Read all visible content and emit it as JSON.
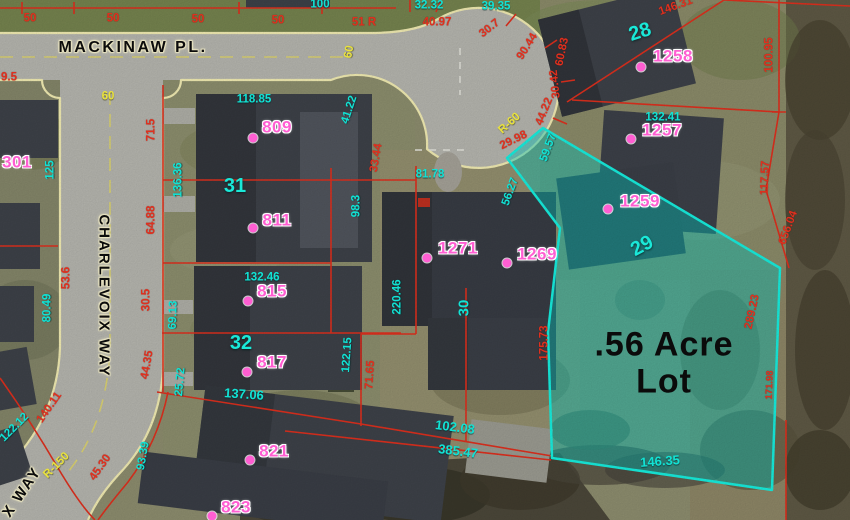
{
  "streets": {
    "mackinaw": "MACKINAW PL.",
    "charlevoix": "CHARLEVOIX WAY",
    "charlevoix_partial": "X WAY"
  },
  "highlight": {
    "area_line1": ".56 Acre",
    "area_line2": "Lot"
  },
  "addresses": [
    {
      "label": "301",
      "x": 17,
      "y": 162,
      "dot": null
    },
    {
      "label": "809",
      "x": 277,
      "y": 127,
      "dot": [
        253,
        138
      ]
    },
    {
      "label": "811",
      "x": 277,
      "y": 220,
      "dot": [
        253,
        228
      ]
    },
    {
      "label": "815",
      "x": 272,
      "y": 291,
      "dot": [
        248,
        301
      ]
    },
    {
      "label": "817",
      "x": 272,
      "y": 362,
      "dot": [
        247,
        372
      ]
    },
    {
      "label": "821",
      "x": 274,
      "y": 451,
      "dot": [
        250,
        460
      ]
    },
    {
      "label": "823",
      "x": 236,
      "y": 507,
      "dot": [
        212,
        516
      ]
    },
    {
      "label": "1258",
      "x": 673,
      "y": 56,
      "dot": [
        641,
        67
      ]
    },
    {
      "label": "1257",
      "x": 662,
      "y": 130,
      "dot": [
        631,
        139
      ]
    },
    {
      "label": "1259",
      "x": 640,
      "y": 201,
      "dot": [
        608,
        209
      ]
    },
    {
      "label": "1271",
      "x": 458,
      "y": 248,
      "dot": [
        427,
        258
      ]
    },
    {
      "label": "1269",
      "x": 537,
      "y": 254,
      "dot": [
        507,
        263
      ]
    }
  ],
  "lot_numbers": [
    {
      "label": "31",
      "x": 235,
      "y": 186,
      "r": 0
    },
    {
      "label": "32",
      "x": 241,
      "y": 343,
      "r": 0
    },
    {
      "label": "28",
      "x": 640,
      "y": 32,
      "r": -18
    },
    {
      "label": "29",
      "x": 642,
      "y": 246,
      "r": -28
    }
  ],
  "dimensions": [
    {
      "t": "50",
      "c": "red",
      "x": 30,
      "y": 19,
      "r": 0
    },
    {
      "t": "50",
      "c": "red",
      "x": 113,
      "y": 19,
      "r": 0
    },
    {
      "t": "50",
      "c": "red",
      "x": 198,
      "y": 20,
      "r": 0
    },
    {
      "t": "50",
      "c": "red",
      "x": 278,
      "y": 21,
      "r": 0
    },
    {
      "t": "100",
      "c": "cyan",
      "x": 320,
      "y": 5,
      "r": 0
    },
    {
      "t": "32.32",
      "c": "cyan",
      "x": 429,
      "y": 6,
      "r": 0
    },
    {
      "t": "39.35",
      "c": "cyan",
      "x": 496,
      "y": 7,
      "r": 0
    },
    {
      "t": "51 R",
      "c": "red",
      "x": 364,
      "y": 23,
      "r": 0
    },
    {
      "t": "40.97",
      "c": "red",
      "x": 437,
      "y": 23,
      "r": 0
    },
    {
      "t": "30.7",
      "c": "red",
      "x": 490,
      "y": 29,
      "r": -38
    },
    {
      "t": "90.44",
      "c": "red",
      "x": 528,
      "y": 47,
      "r": -58
    },
    {
      "t": "60.83",
      "c": "red",
      "x": 563,
      "y": 52,
      "r": -78
    },
    {
      "t": "30.42",
      "c": "red",
      "x": 556,
      "y": 84,
      "r": -96
    },
    {
      "t": "44.22",
      "c": "red",
      "x": 545,
      "y": 112,
      "r": -68
    },
    {
      "t": "R-60",
      "c": "yellow",
      "x": 510,
      "y": 124,
      "r": -42
    },
    {
      "t": "29.98",
      "c": "red",
      "x": 514,
      "y": 141,
      "r": -26
    },
    {
      "t": "59.57",
      "c": "cyan",
      "x": 549,
      "y": 148,
      "r": -70
    },
    {
      "t": "56.27",
      "c": "cyan",
      "x": 511,
      "y": 192,
      "r": -70
    },
    {
      "t": "60",
      "c": "yellow",
      "x": 350,
      "y": 52,
      "r": -80
    },
    {
      "t": "60",
      "c": "yellow",
      "x": 108,
      "y": 97,
      "r": 0
    },
    {
      "t": "9.5",
      "c": "red",
      "x": 9,
      "y": 78,
      "r": 0
    },
    {
      "t": "118.85",
      "c": "cyan",
      "x": 254,
      "y": 100,
      "r": 0
    },
    {
      "t": "41.22",
      "c": "cyan",
      "x": 350,
      "y": 110,
      "r": -72
    },
    {
      "t": "33.44",
      "c": "red",
      "x": 377,
      "y": 158,
      "r": -80
    },
    {
      "t": "98.3",
      "c": "cyan",
      "x": 357,
      "y": 206,
      "r": -90
    },
    {
      "t": "81.78",
      "c": "cyan",
      "x": 430,
      "y": 175,
      "r": 0
    },
    {
      "t": "220.46",
      "c": "cyan",
      "x": 398,
      "y": 297,
      "r": -90
    },
    {
      "t": "30",
      "c": "cyan",
      "x": 464,
      "y": 308,
      "r": -90,
      "s": 15
    },
    {
      "t": "132.41",
      "c": "cyan",
      "x": 663,
      "y": 118,
      "r": 0
    },
    {
      "t": "146.31",
      "c": "red",
      "x": 676,
      "y": 7,
      "r": -20
    },
    {
      "t": "100.95",
      "c": "red",
      "x": 770,
      "y": 55,
      "r": -90
    },
    {
      "t": "117.57",
      "c": "red",
      "x": 766,
      "y": 178,
      "r": -88
    },
    {
      "t": "656.04",
      "c": "red",
      "x": 789,
      "y": 228,
      "r": -70
    },
    {
      "t": "289.23",
      "c": "red",
      "x": 753,
      "y": 312,
      "r": -78
    },
    {
      "t": "171.98",
      "c": "red",
      "x": 770,
      "y": 385,
      "r": -88,
      "s": 9.5
    },
    {
      "t": "175.73",
      "c": "red",
      "x": 545,
      "y": 343,
      "r": -90
    },
    {
      "t": "146.35",
      "c": "cyan",
      "x": 660,
      "y": 461,
      "r": -4,
      "s": 13
    },
    {
      "t": "102.08",
      "c": "cyan",
      "x": 455,
      "y": 427,
      "r": 7,
      "s": 13
    },
    {
      "t": "385.47",
      "c": "cyan",
      "x": 458,
      "y": 451,
      "r": 7,
      "s": 13
    },
    {
      "t": "125",
      "c": "cyan",
      "x": 51,
      "y": 170,
      "r": -90
    },
    {
      "t": "71.5",
      "c": "red",
      "x": 152,
      "y": 130,
      "r": -90
    },
    {
      "t": "136.36",
      "c": "cyan",
      "x": 179,
      "y": 180,
      "r": -90
    },
    {
      "t": "64.88",
      "c": "red",
      "x": 152,
      "y": 220,
      "r": -90
    },
    {
      "t": "53.6",
      "c": "red",
      "x": 67,
      "y": 278,
      "r": -90
    },
    {
      "t": "80.49",
      "c": "cyan",
      "x": 48,
      "y": 308,
      "r": -90
    },
    {
      "t": "30.5",
      "c": "red",
      "x": 147,
      "y": 300,
      "r": -90
    },
    {
      "t": "69.13",
      "c": "cyan",
      "x": 174,
      "y": 315,
      "r": -88
    },
    {
      "t": "44.35",
      "c": "red",
      "x": 148,
      "y": 365,
      "r": -80
    },
    {
      "t": "25.72",
      "c": "cyan",
      "x": 181,
      "y": 382,
      "r": -85
    },
    {
      "t": "132.46",
      "c": "cyan",
      "x": 262,
      "y": 278,
      "r": 0
    },
    {
      "t": "137.06",
      "c": "cyan",
      "x": 244,
      "y": 394,
      "r": 4,
      "s": 13
    },
    {
      "t": "122.15",
      "c": "cyan",
      "x": 348,
      "y": 355,
      "r": -86
    },
    {
      "t": "71.65",
      "c": "red",
      "x": 371,
      "y": 375,
      "r": -86
    },
    {
      "t": "93.39",
      "c": "cyan",
      "x": 144,
      "y": 456,
      "r": -80
    },
    {
      "t": "140.11",
      "c": "red",
      "x": 50,
      "y": 408,
      "r": -55
    },
    {
      "t": "122.12",
      "c": "cyan",
      "x": 15,
      "y": 428,
      "r": -45
    },
    {
      "t": "R-150",
      "c": "yellow",
      "x": 57,
      "y": 466,
      "r": -45
    },
    {
      "t": "45.30",
      "c": "red",
      "x": 101,
      "y": 468,
      "r": -55
    }
  ],
  "colors": {
    "c-red": "#e0301e",
    "c-cyan": "#12e2d4",
    "c-cyan2": "#1ae8d8",
    "c-pink": "#ff5ed2",
    "c-yellow": "#e9e23e",
    "c-curb": "#f4eeb4",
    "hl-fill": "rgba(0,205,195,0.42)",
    "hl-stroke": "#17f0e0"
  }
}
